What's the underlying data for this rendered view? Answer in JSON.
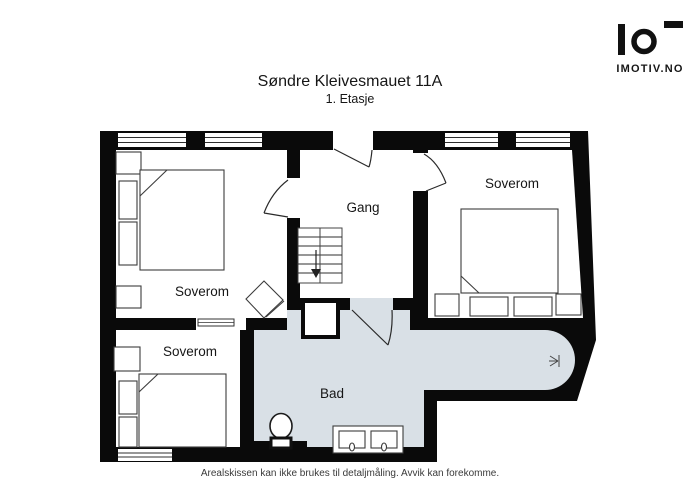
{
  "header": {
    "title": "Søndre Kleivesmauet 11A",
    "subtitle": "1. Etasje"
  },
  "logo": {
    "text": "IMOTIV.NO"
  },
  "floorplan": {
    "floor_name": "1. Etasje",
    "rooms": [
      {
        "label": "Soverom",
        "position": "top-left"
      },
      {
        "label": "Gang",
        "position": "top-middle"
      },
      {
        "label": "Soverom",
        "position": "top-right"
      },
      {
        "label": "Soverom",
        "position": "bottom-left"
      },
      {
        "label": "Bad",
        "position": "bottom-middle"
      }
    ],
    "features": [
      "staircase-down-arrow",
      "entrance-door-swing",
      "interior-door-swings",
      "sliding-door",
      "double-bed-x3",
      "nightstands",
      "chair",
      "toilet",
      "double-sink-vanity",
      "chimney-shaft",
      "shower-head-icon",
      "windows-top-wall-x4",
      "window-bottom-wall-x1"
    ],
    "colors": {
      "wall": "#0a0a0a",
      "bathroom_floor": "#d9e0e6",
      "room_floor": "#ffffff"
    }
  },
  "footer": {
    "disclaimer": "Arealskissen kan ikke brukes til detaljmåling. Avvik kan forekomme."
  }
}
